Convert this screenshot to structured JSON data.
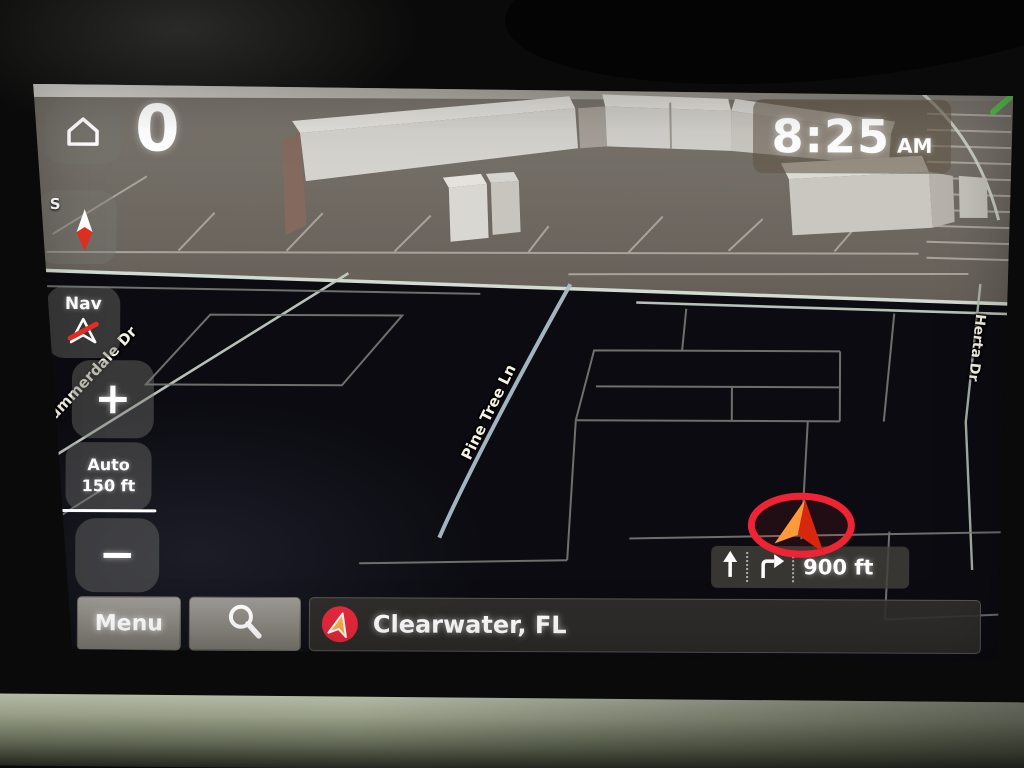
{
  "app": {
    "name": "car-navigation-system"
  },
  "status_bar": {
    "speed": "0",
    "time": "8:25",
    "meridiem": "AM"
  },
  "compass": {
    "cardinal": "S"
  },
  "map_controls": {
    "nav_button": "Nav",
    "zoom_in": "+",
    "zoom_out": "−",
    "scale_mode": "Auto",
    "scale_value": "150 ft"
  },
  "guidance": {
    "distance_to_turn": "900 ft",
    "maneuvers": [
      "straight-arrow-icon",
      "turn-right-arrow-icon"
    ]
  },
  "bottom_bar": {
    "menu_button": "Menu",
    "current_location": "Clearwater, FL"
  },
  "map": {
    "street_labels": [
      {
        "text": "Summerdale Dr"
      },
      {
        "text": "Pine Tree Ln"
      },
      {
        "text": "Herta Dr"
      }
    ]
  },
  "icons": {
    "home": "home-icon",
    "compass": "compass-needle-icon",
    "nav": "nav-arrow-muted-icon",
    "search": "magnifier-icon",
    "location": "location-arrow-badge-icon",
    "vehicle": "vehicle-arrow-icon"
  },
  "colors": {
    "highlight_ring": "#ee2334",
    "vehicle_arrow_light": "#ff9a3c",
    "vehicle_arrow_dark": "#d8270e",
    "poi_badge": "#e8293c",
    "road_bright": "#c8d1c7",
    "road_dim": "#7e817d",
    "route_road_blue": "#a9bfc9",
    "map_dark": "#0b0b11",
    "plaza_ground": "#6e6a62",
    "trim_sage": "#99a089"
  }
}
